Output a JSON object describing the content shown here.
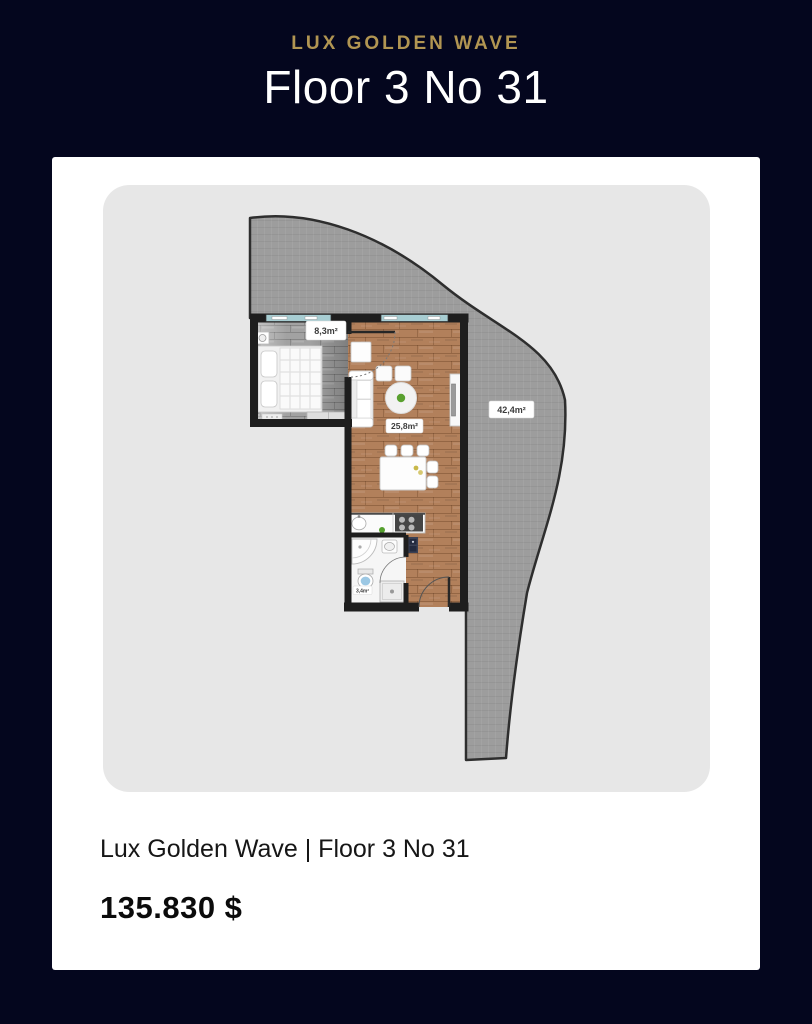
{
  "header": {
    "brand": "LUX GOLDEN WAVE",
    "title": "Floor 3 No 31"
  },
  "card": {
    "caption": "Lux Golden Wave | Floor 3 No 31",
    "price": "135.830 $"
  },
  "floorplan": {
    "bedroom_area": "8,3m²",
    "living_area": "25,8m²",
    "bathroom_area": "3,4m²",
    "terrace_area": "42,4m²"
  },
  "colors": {
    "background": "#04061e",
    "accent_gold": "#b19552",
    "card": "#ffffff",
    "plan_background": "#e7e7e7",
    "terrace": "#9d9d9d",
    "wall": "#1e1e1e",
    "wood_floor": "#b2805b",
    "window": "#a7cdd2"
  }
}
